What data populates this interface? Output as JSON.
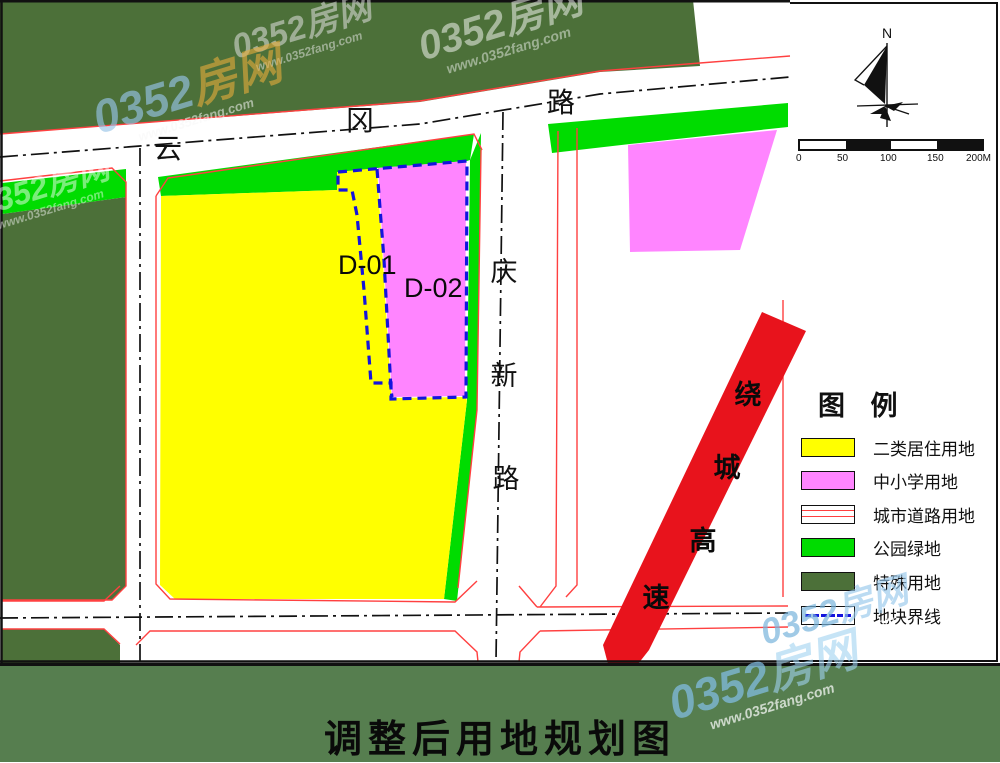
{
  "colors": {
    "residential": "#FFFF00",
    "school": "#FF85FF",
    "road_fill": "#FFFFFF",
    "road_edge": "#FF4040",
    "park": "#00DC00",
    "special": "#4C7039",
    "boundary": "#1414DD",
    "expressway": "#E8131C",
    "footer_band": "#567E4F",
    "centerline": "#111111"
  },
  "map": {
    "roads": {
      "yungang": {
        "name": "云冈路",
        "chars": [
          "云",
          "冈",
          "路"
        ]
      },
      "qingxin": {
        "name": "庆新路",
        "chars": [
          "庆",
          "新",
          "路"
        ]
      },
      "expressway": {
        "name": "绕城高速",
        "chars": [
          "绕",
          "城",
          "高",
          "速"
        ]
      }
    },
    "parcels": {
      "d01": "D-01",
      "d02": "D-02"
    }
  },
  "sidebar": {
    "north_label": "N",
    "scale": {
      "ticks": [
        "0",
        "50",
        "100",
        "150",
        "200M"
      ]
    },
    "legend": {
      "title": "图 例",
      "items": [
        {
          "label": "二类居住用地",
          "swatch": "residential"
        },
        {
          "label": "中小学用地",
          "swatch": "school"
        },
        {
          "label": "城市道路用地",
          "swatch": "road"
        },
        {
          "label": "公园绿地",
          "swatch": "park"
        },
        {
          "label": "特殊用地",
          "swatch": "special"
        },
        {
          "label": "地块界线",
          "swatch": "boundary"
        }
      ]
    }
  },
  "title": {
    "text": "调整后用地规划图"
  },
  "watermark": {
    "brand": "0352房网",
    "brand_num": "0352",
    "brand_cn": "房网",
    "url": "www.0352fang.com"
  }
}
